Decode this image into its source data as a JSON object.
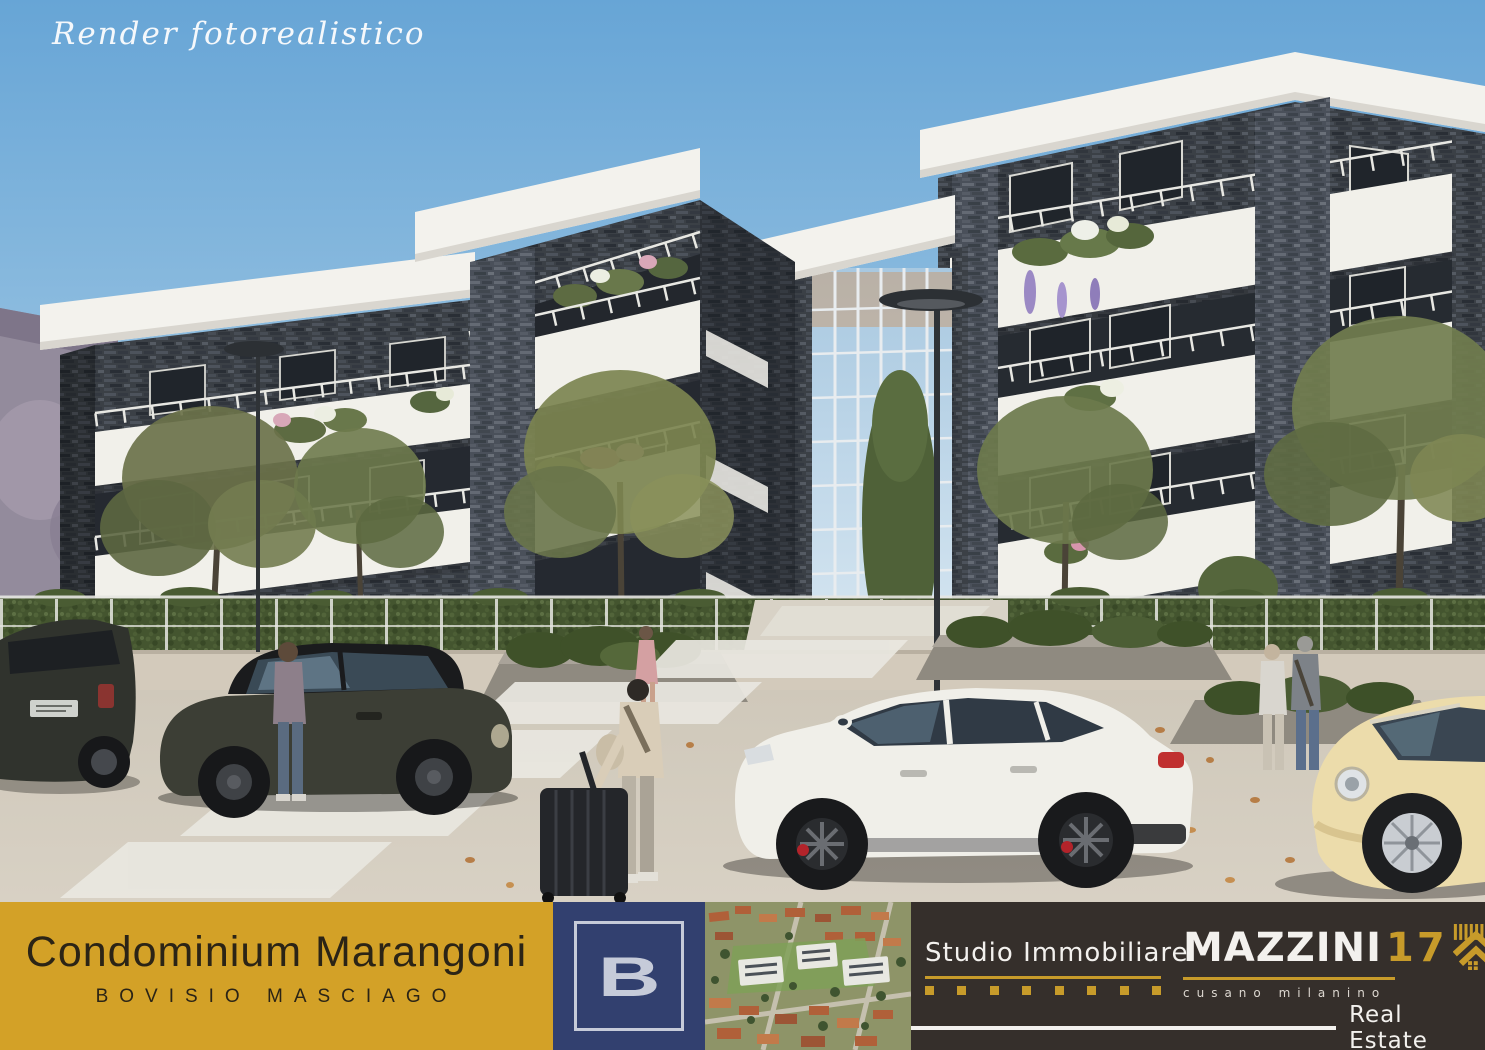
{
  "watermark": "Render fotorealistico",
  "footer": {
    "project": {
      "title": "Condominium Marangoni",
      "subtitle": "BOVISIO MASCIAGO",
      "bg": "#D3A127",
      "text": "#2B2416"
    },
    "builder": {
      "letter": "B",
      "bg": "#32406F",
      "accent": "#C6CBD9"
    },
    "agency": {
      "studio": "Studio Immobiliare",
      "brand_name": "MAZZINI",
      "brand_number": "17",
      "brand_area": "cusano milanino",
      "brand_suffix": "RE",
      "tagline": "Real Estate",
      "bg": "#352F2B",
      "gold": "#C79B2A"
    }
  },
  "scene_palette": {
    "sky_top": "#67A5D6",
    "sky_horizon": "#CFE2EE",
    "brick": "#3B4046",
    "concrete_white": "#F3F2ED",
    "pavement": "#D2CBBD",
    "foliage": "#6E7C4F"
  }
}
